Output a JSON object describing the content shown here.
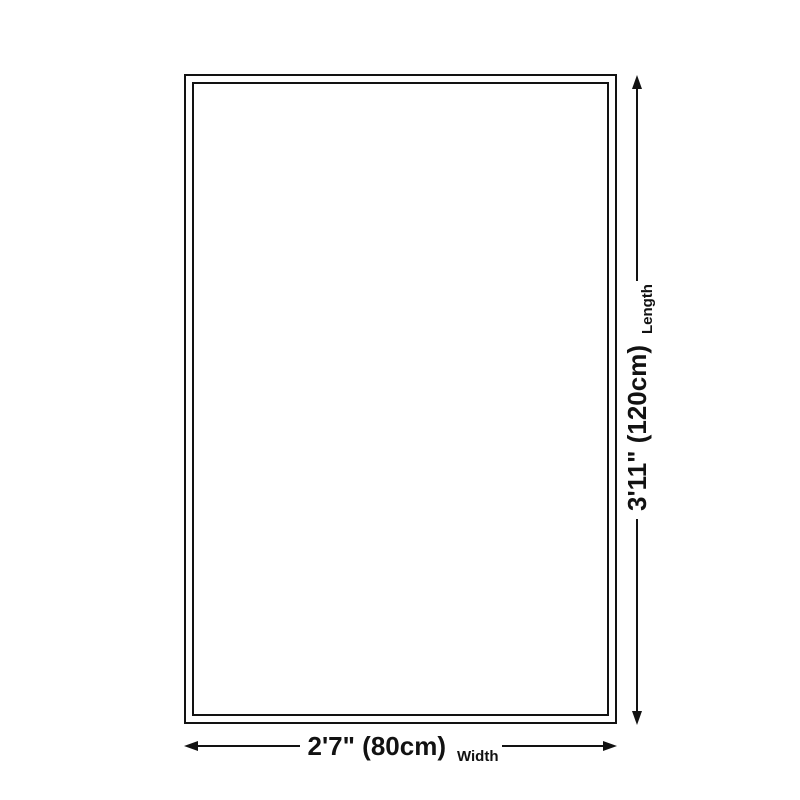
{
  "diagram": {
    "colors": {
      "ink": "#121212",
      "bg": "#ffffff"
    },
    "length": {
      "value": "3'11\" (120cm)",
      "label": "Length"
    },
    "width": {
      "value": "2'7\" (80cm)",
      "label": "Width"
    }
  }
}
